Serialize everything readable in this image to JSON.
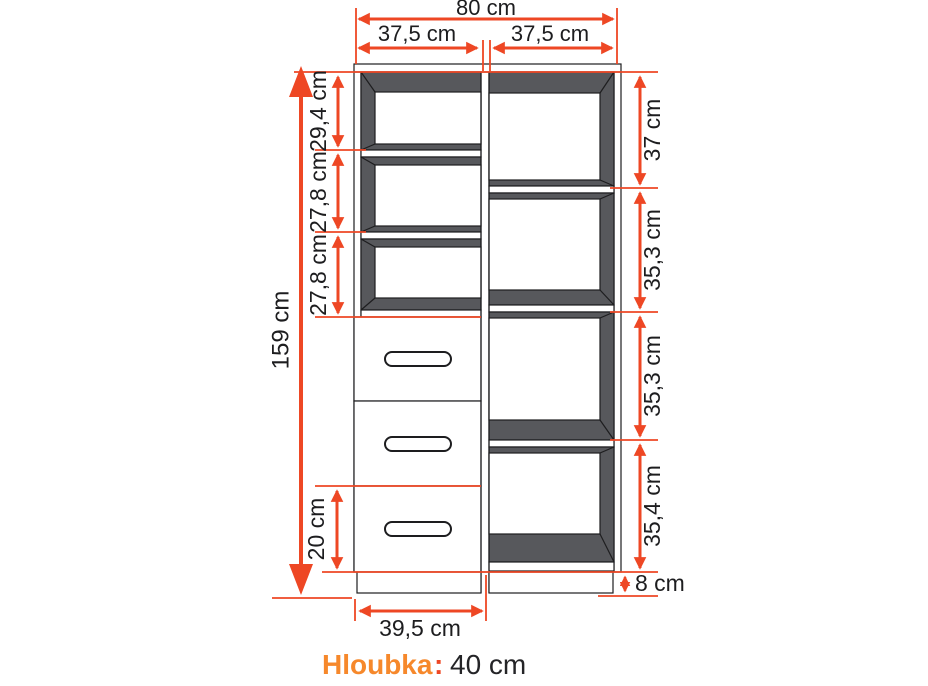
{
  "diagram": {
    "type": "furniture-dimension-drawing",
    "unit": "cm",
    "dimensions": {
      "total_width": "80 cm",
      "column_widths": [
        "37,5 cm",
        "37,5 cm"
      ],
      "total_height": "159 cm",
      "left_sections": [
        "29,4 cm",
        "27,8 cm",
        "27,8 cm"
      ],
      "right_sections": [
        "37 cm",
        "35,3 cm",
        "35,3 cm",
        "35,4 cm"
      ],
      "bottom_drawer_height": "20 cm",
      "base_width": "39,5 cm",
      "base_height": "8 cm"
    },
    "footer": {
      "label": "Hloubka",
      "separator": ":",
      "value": "40 cm"
    },
    "structure": {
      "left_column": "3 open shelves + 3 drawers",
      "right_column": "4 open shelves",
      "drawer_count": 3
    },
    "colors": {
      "dimension_red": "#ee4724",
      "accent_orange": "#f6882b",
      "cabinet_shade": "#57585c",
      "outline": "#1d1d1f",
      "background": "#ffffff"
    }
  }
}
